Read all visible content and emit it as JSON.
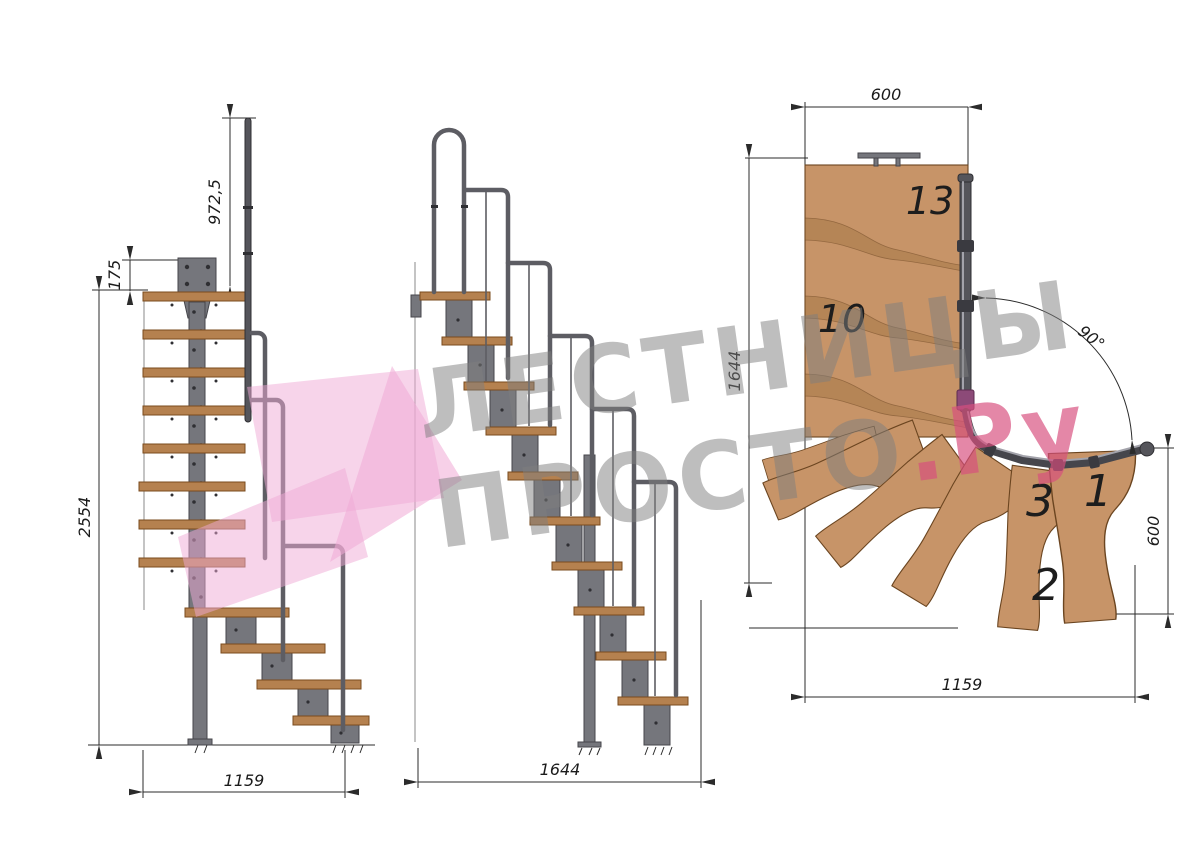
{
  "drawing": {
    "watermark": {
      "line1": "ЛЕСТНИЦЫ",
      "line2_gray": "ПРОСТО",
      "line2_pink": ".Ру"
    },
    "side_view": {
      "dim_handrail_height": "972,5",
      "dim_top_offset": "175",
      "dim_total_height": "2554",
      "dim_run": "1159"
    },
    "front_view": {
      "dim_run": "1644"
    },
    "plan_view": {
      "dim_width_top": "600",
      "dim_depth_left": "1644",
      "dim_turn_angle": "90°",
      "dim_width_right": "600",
      "dim_run_bottom": "1159",
      "step_numbers": {
        "top": "13",
        "middle": "10",
        "n3": "3",
        "n1": "1",
        "n2": "2"
      }
    }
  },
  "colors": {
    "wood": "#c79468",
    "wood_outline": "#6b4520",
    "wood_shade": "#a87a48",
    "tread_side": "#b5814f",
    "tread_side_outline": "#7a4b1e",
    "steel": "#75767c",
    "steel_dark": "#55555b",
    "steel_outline": "#46464b",
    "rail": "#5d5d63",
    "drawing_line": "#2b2b2b",
    "watermark_gray": "#7f7f7f",
    "watermark_pink": "#d84f7e",
    "arrow_pink": "#f0a9d6",
    "joint_magenta": "#8c4a78"
  }
}
